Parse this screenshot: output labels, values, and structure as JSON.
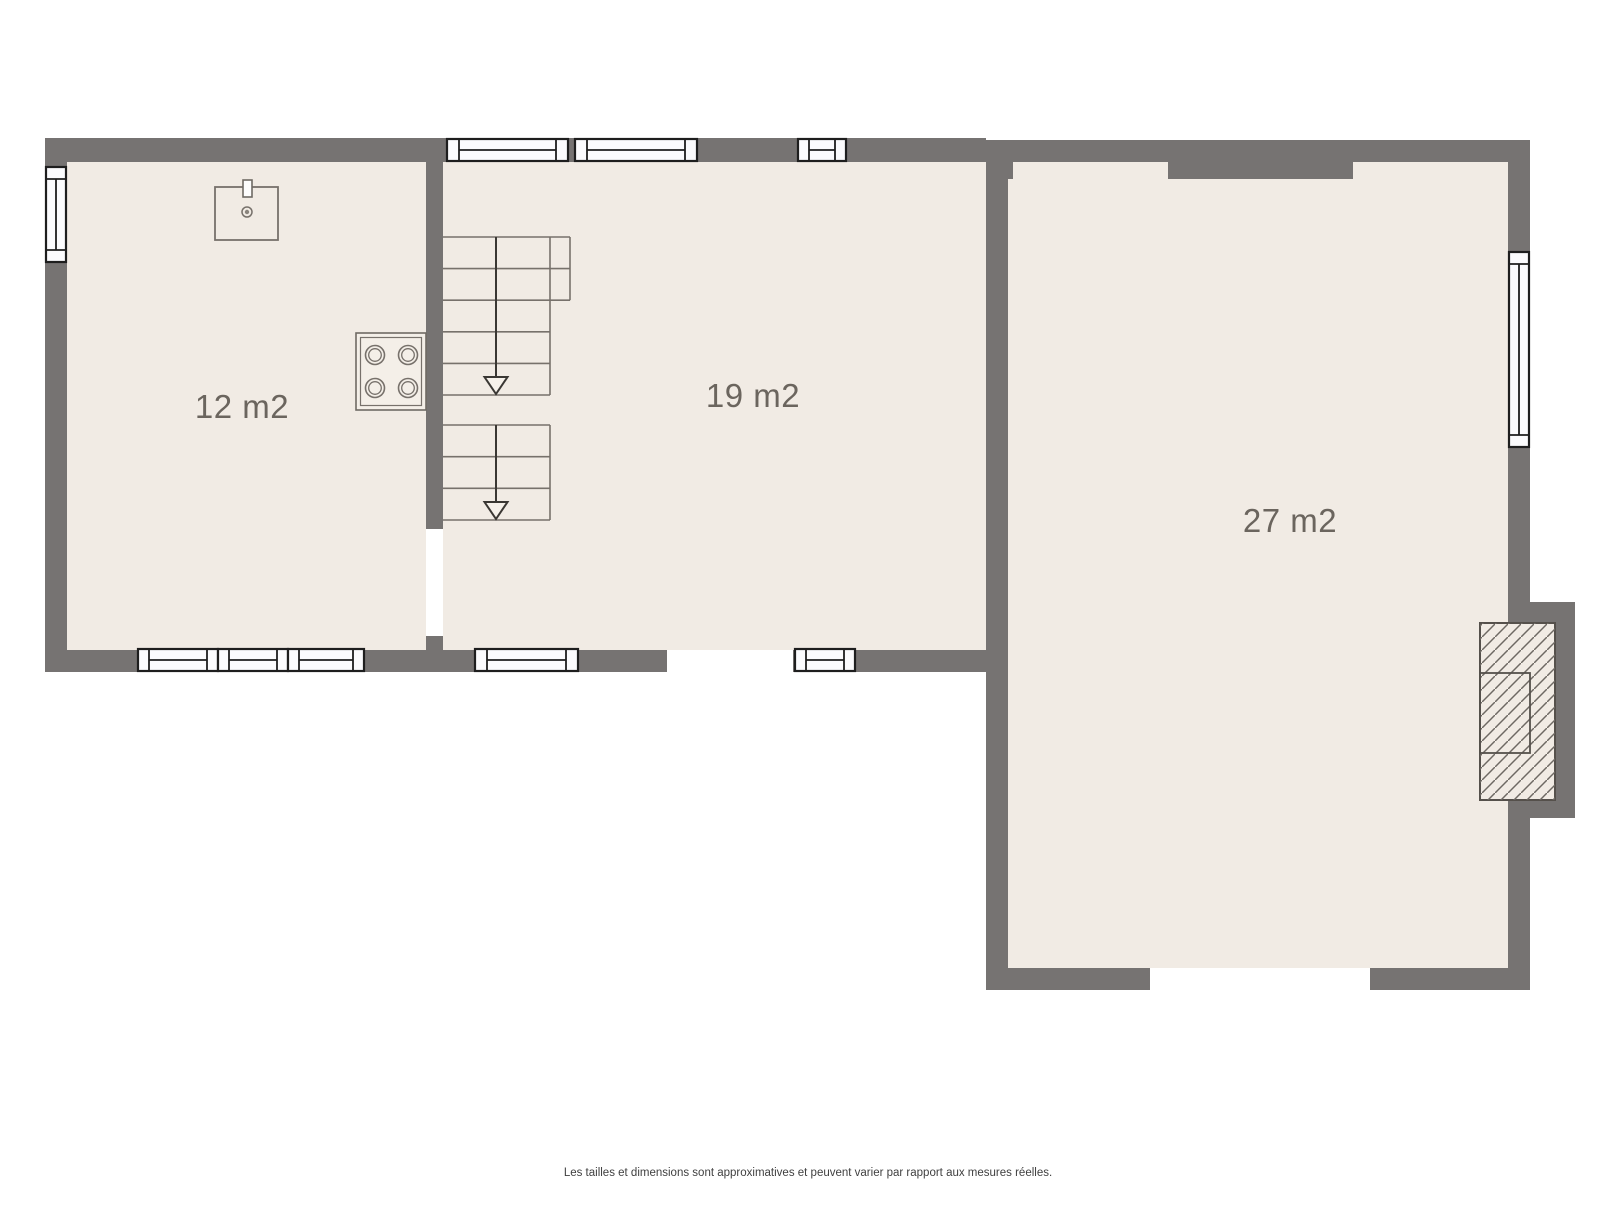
{
  "floor_plan": {
    "rooms": [
      {
        "id": "room-1",
        "area_label": "12 m2"
      },
      {
        "id": "room-2",
        "area_label": "19 m2"
      },
      {
        "id": "room-3",
        "area_label": "27 m2"
      }
    ],
    "fixtures": [
      "sink-icon",
      "stove-icon",
      "stairs-down-arrow-icon",
      "fireplace-icon",
      "window-symbol"
    ],
    "colors": {
      "floor": "#f1ebe4",
      "wall": "#767372",
      "window_fill": "#fbfbfd",
      "window_stroke": "#1e1e1e",
      "stair_step": "#77716b",
      "stair_arrow": "#3a3733",
      "label_text": "#6b655e",
      "disclaimer_text": "#404040",
      "background": "#ffffff"
    }
  },
  "footer": {
    "disclaimer": "Les tailles et dimensions sont approximatives et peuvent varier par rapport aux mesures réelles."
  }
}
